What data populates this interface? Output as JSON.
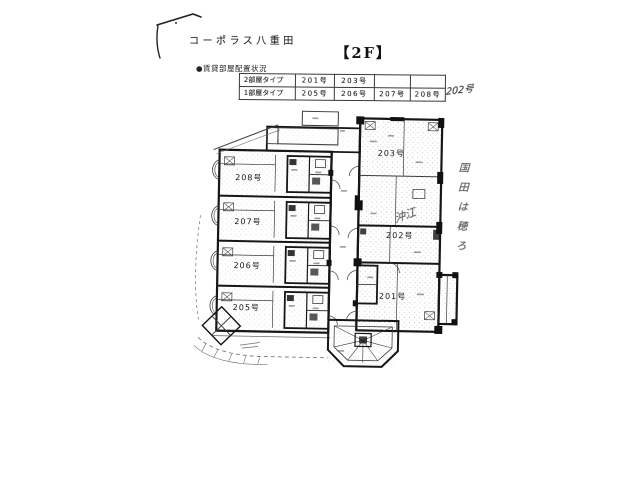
{
  "header": {
    "title": "コーポラス八重田",
    "floor_label": "【2F】"
  },
  "occupancy_table": {
    "caption": "●賃貸部屋配置状況",
    "rows": [
      {
        "type": "2部屋タイプ",
        "cells": [
          "201号",
          "203号",
          "",
          ""
        ]
      },
      {
        "type": "1部屋タイプ",
        "cells": [
          "205号",
          "206号",
          "207号",
          "208号"
        ]
      }
    ],
    "handwritten_addendum": "202号"
  },
  "plan": {
    "units": [
      {
        "id": "208",
        "label": "208号"
      },
      {
        "id": "207",
        "label": "207号"
      },
      {
        "id": "206",
        "label": "206号"
      },
      {
        "id": "205",
        "label": "205号"
      },
      {
        "id": "203",
        "label": "203号"
      },
      {
        "id": "202",
        "label": "202号"
      },
      {
        "id": "201",
        "label": "201号"
      }
    ],
    "handwritten_notes": {
      "tenant_note": "沖江",
      "margin_note": "国田は穂ろ"
    }
  }
}
